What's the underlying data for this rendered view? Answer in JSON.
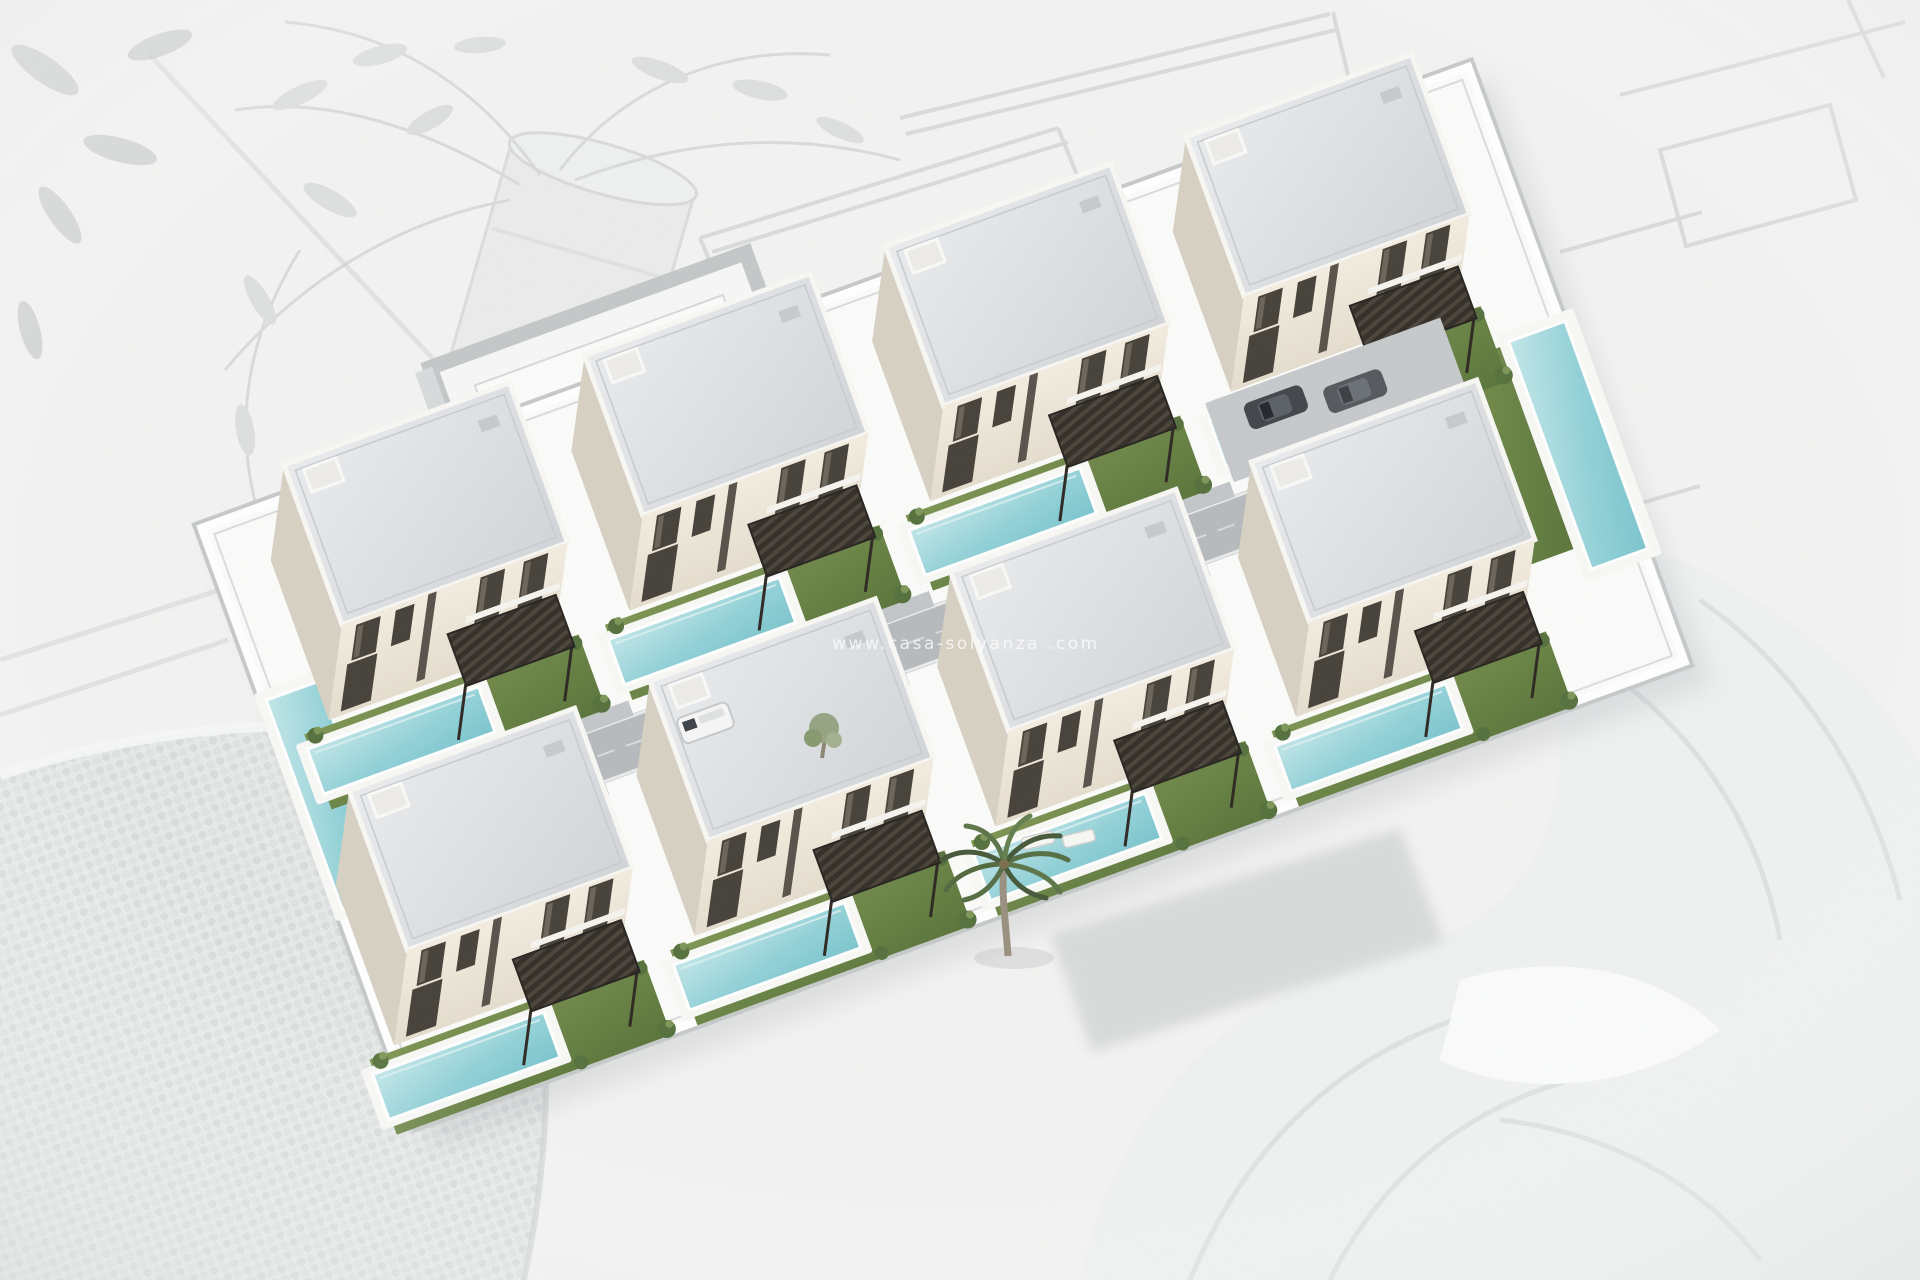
{
  "watermark": {
    "text": "www.casa-solyanza .com"
  },
  "scene": {
    "description": "Aerial 3D render of a residential development with modern white two-storey villas, private pools, lawns and dark pergolas, presented over a faded architect desk photo with blueprints, an olive-branch pot and a knitted blanket",
    "villa_count": 8,
    "rows": 2,
    "palette": {
      "background": "#f3f3f2",
      "roof": "#d9dcdf",
      "facade": "#f0e9dc",
      "facade_shadow": "#d7d1c3",
      "lawn": "#6d894a",
      "pool": "#8fd0d6",
      "pergola": "#332e27",
      "road": "#b7babd",
      "boundary_wall": "#c9cccd",
      "palm": "#53693f"
    }
  }
}
